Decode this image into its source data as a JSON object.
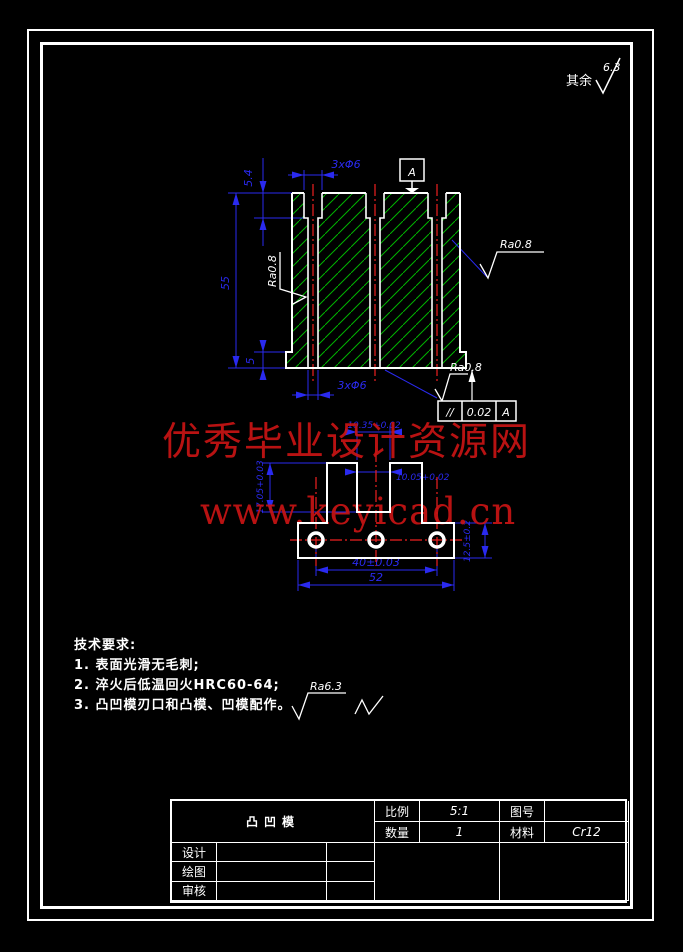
{
  "colors": {
    "background": "#000000",
    "line": "#ffffff",
    "dimension": "#2a2af0",
    "hatch": "#00b400",
    "centerline": "#ee2020",
    "watermark": "#c81414"
  },
  "general_note": {
    "prefix": "其余",
    "value": "6.3"
  },
  "watermark": {
    "line1": "优秀毕业设计资源网",
    "line2": "www.keyicad.cn"
  },
  "front_view": {
    "dim_top_holes": "3xΦ6",
    "dim_counterbore_depth": "5.4",
    "dim_overall_height": "55",
    "dim_step_height": "5",
    "dim_bottom_holes": "3xΦ6",
    "roughness_left": "Ra0.8",
    "roughness_right": "Ra0.8",
    "roughness_bottom": "Ra0.8",
    "datum_label": "A",
    "fcf": {
      "symbol": "//",
      "tolerance": "0.02",
      "datum": "A"
    }
  },
  "bottom_view": {
    "dim_slot_width_top": "10.35+0.02",
    "dim_slot_width_bottom": "10.05+0.02",
    "dim_slot_depth": "17.05+0.03",
    "dim_flange_thickness": "12.5±0.2",
    "dim_hole_spacing": "40±0.03",
    "dim_overall_width": "52"
  },
  "tech_requirements": {
    "title": "技术要求:",
    "items": [
      "1. 表面光滑无毛刺;",
      "2. 淬火后低温回火HRC60-64;",
      "3. 凸凹模刃口和凸模、凹模配作。"
    ],
    "roughness_note": "Ra6.3"
  },
  "title_block": {
    "part_name": "凸凹模",
    "scale_label": "比例",
    "scale_value": "5:1",
    "qty_label": "数量",
    "qty_value": "1",
    "drawing_no_label": "图号",
    "drawing_no_value": "",
    "material_label": "材料",
    "material_value": "Cr12",
    "sign_rows": [
      {
        "label": "设计"
      },
      {
        "label": "绘图"
      },
      {
        "label": "审核"
      }
    ]
  }
}
